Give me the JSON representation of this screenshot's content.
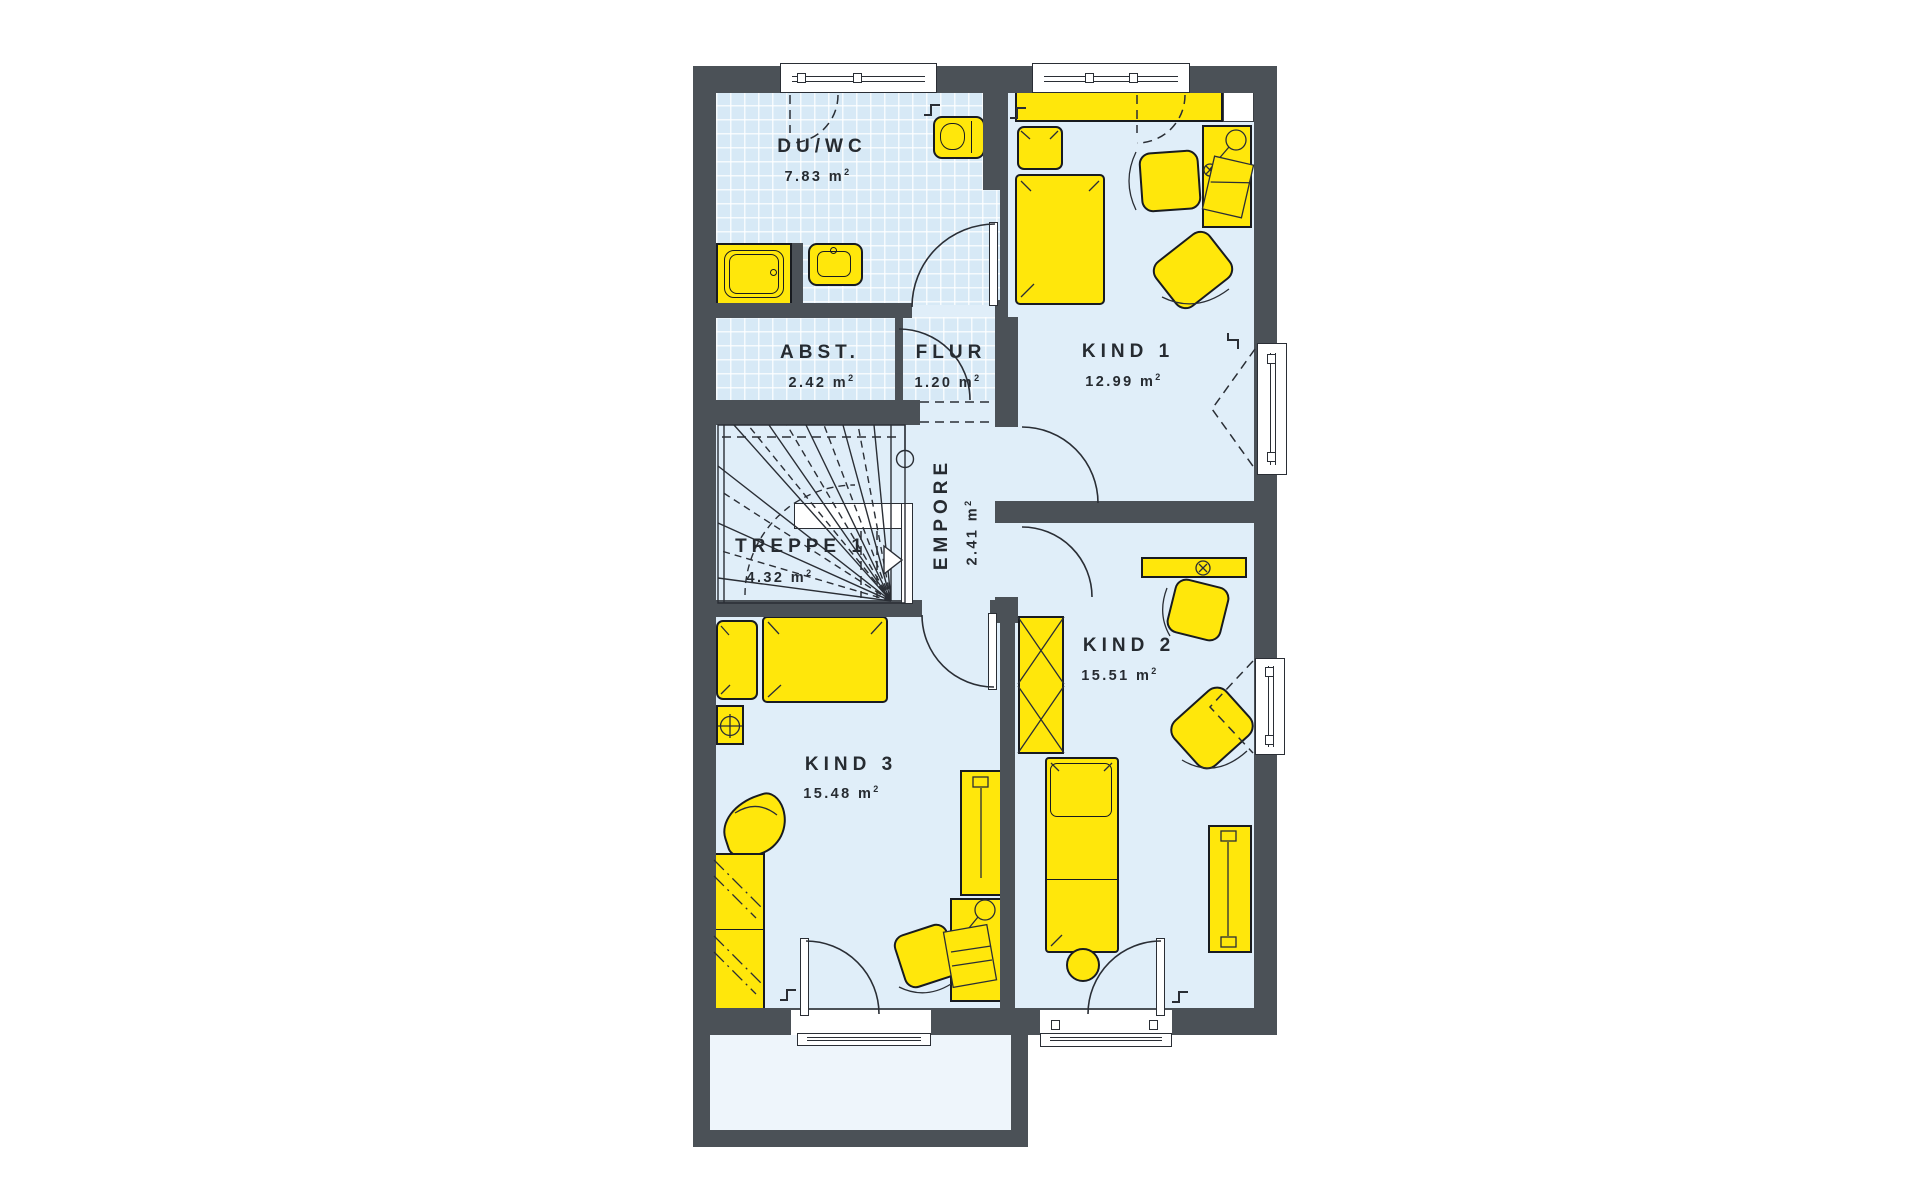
{
  "plan_title": "upper-floor-plan",
  "rooms": {
    "duwc": {
      "label": "DU/WC",
      "area": "7.83 m",
      "sup": "2"
    },
    "abst": {
      "label": "ABST.",
      "area": "2.42 m",
      "sup": "2"
    },
    "flur": {
      "label": "FLUR",
      "area": "1.20 m",
      "sup": "2"
    },
    "treppe": {
      "label": "TREPPE 1",
      "area": "4.32 m",
      "sup": "2"
    },
    "empore": {
      "label": "EMPORE",
      "area": "2.41 m",
      "sup": "2"
    },
    "kind1": {
      "label": "KIND 1",
      "area": "12.99 m",
      "sup": "2"
    },
    "kind2": {
      "label": "KIND 2",
      "area": "15.51 m",
      "sup": "2"
    },
    "kind3": {
      "label": "KIND 3",
      "area": "15.48 m",
      "sup": "2"
    }
  },
  "colors": {
    "wall": "#4b5157",
    "floor": "#e0eef9",
    "tiled_floor": "#d7e9f6",
    "furniture": "#FFE70B",
    "outline": "#2a2e35",
    "label_text": "#262b31"
  }
}
